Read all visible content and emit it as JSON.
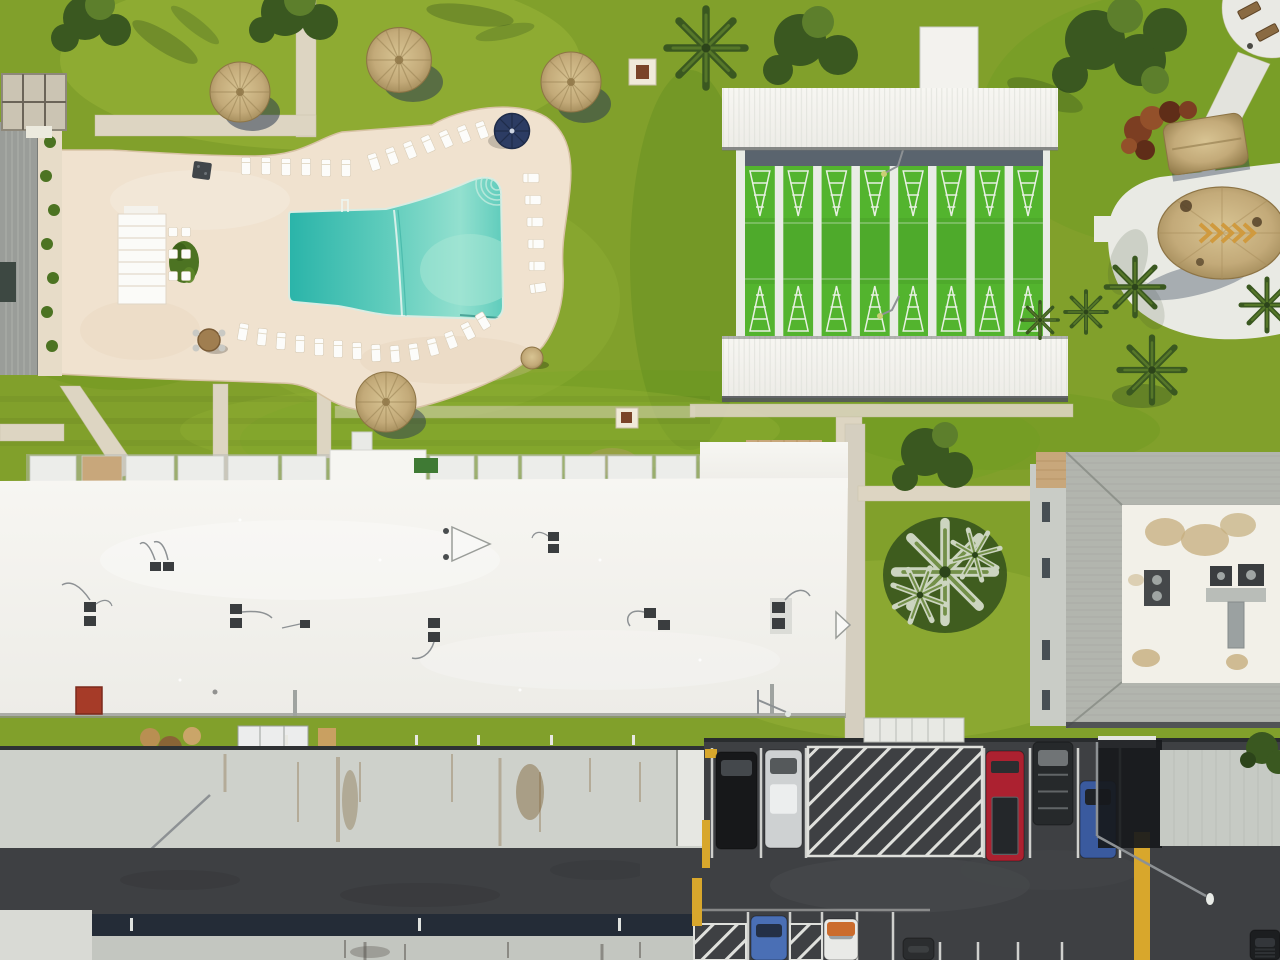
{
  "meta": {
    "title": "Aerial drone photo of a residential community recreation area",
    "view": "top-down orthographic aerial",
    "time_of_day": "midday, sun from upper-left",
    "width_px": 1280,
    "height_px": 960
  },
  "palette": {
    "grass_base": "#81a02b",
    "grass_light": "#9db73c",
    "grass_dark": "#628e1f",
    "grass_shadow": "#3a5a1c",
    "concrete": "#ddd5c2",
    "concrete_dark": "#c8bfa8",
    "deck": "#f0e2cf",
    "deck_edge": "#d8c3a6",
    "pool_deep": "#2ab4a9",
    "pool_mid": "#5fccbc",
    "pool_light": "#93e0cf",
    "lounger": "#fcfcfa",
    "umbrella": "#2c3c63",
    "roof_white": "#f3f2ee",
    "ridge": "#dcded7",
    "court_green": "#53b42e",
    "court_line": "#f0f4ec",
    "court_base": "#e9ece6",
    "walkway": "#5a646e",
    "thatch": "#c3aa79",
    "thatch_dark": "#97804f",
    "thatch_light": "#d8c493",
    "shadow_navy": "#2e3c52",
    "gray_roof": "#ced1cb",
    "rust": "#85653c",
    "asphalt": "#3e4043",
    "navy_band": "#242c37",
    "bottom_strip": "#c3c6c0",
    "line": "#dfe0dc",
    "yellow": "#d8a72c",
    "chimney": "#a63b28",
    "ac_unit": "#3a3d3f",
    "pipe": "#8d9194",
    "shingle": "#b2b5ae",
    "wall": "#c9ccc6",
    "condo_white": "#f2f0e8",
    "stain": "#c5ae7d",
    "duct": "#9ba1a1",
    "palm": "#3a5820",
    "palm_light": "#5d7f2c",
    "palm_silver": "#ccd5c0",
    "paver": "#c8a77b"
  },
  "features": {
    "pool": {
      "label": "free-form swimming pool with curved steps, lane rope and ladder",
      "deck": "cream concrete pool deck",
      "umbrella": "navy blue patio umbrella",
      "cabana": "white cabana with dining tables",
      "loungers": [
        [
          246,
          166,
          0,
          "v"
        ],
        [
          266,
          166,
          0,
          "v"
        ],
        [
          286,
          167,
          0,
          "v"
        ],
        [
          306,
          167,
          0,
          "v"
        ],
        [
          326,
          168,
          0,
          "v"
        ],
        [
          346,
          168,
          0,
          "v"
        ],
        [
          374,
          162,
          -18,
          "v"
        ],
        [
          392,
          156,
          -20,
          "v"
        ],
        [
          410,
          150,
          -22,
          "v"
        ],
        [
          428,
          144,
          -24,
          "v"
        ],
        [
          446,
          139,
          -24,
          "v"
        ],
        [
          464,
          134,
          -22,
          "v"
        ],
        [
          482,
          130,
          -20,
          "v"
        ],
        [
          531,
          178,
          0,
          "h"
        ],
        [
          533,
          200,
          0,
          "h"
        ],
        [
          535,
          222,
          0,
          "h"
        ],
        [
          536,
          244,
          0,
          "h"
        ],
        [
          537,
          266,
          0,
          "h"
        ],
        [
          538,
          288,
          -8,
          "h"
        ],
        [
          243,
          332,
          10,
          "v"
        ],
        [
          262,
          337,
          6,
          "v"
        ],
        [
          281,
          341,
          4,
          "v"
        ],
        [
          300,
          344,
          2,
          "v"
        ],
        [
          319,
          347,
          0,
          "v"
        ],
        [
          338,
          349,
          0,
          "v"
        ],
        [
          357,
          351,
          -2,
          "v"
        ],
        [
          376,
          353,
          -3,
          "v"
        ],
        [
          395,
          354,
          -5,
          "v"
        ],
        [
          414,
          352,
          -9,
          "v"
        ],
        [
          433,
          347,
          -15,
          "v"
        ],
        [
          451,
          340,
          -21,
          "v"
        ],
        [
          468,
          331,
          -27,
          "v"
        ],
        [
          483,
          321,
          -31,
          "v"
        ],
        [
          173,
          232,
          0,
          "s"
        ],
        [
          186,
          232,
          0,
          "s"
        ],
        [
          173,
          254,
          0,
          "s"
        ],
        [
          186,
          254,
          0,
          "s"
        ],
        [
          173,
          276,
          0,
          "s"
        ],
        [
          186,
          276,
          0,
          "s"
        ]
      ]
    },
    "shuffleboard": {
      "label": "covered shuffleboard courts with white metal canopies",
      "lane_count": 8
    },
    "tiki_huts": {
      "label": "thatched palapa umbrellas and huts",
      "umbrella_count": 4,
      "pavilion_count": 2
    },
    "buildings": [
      {
        "name": "clubhouse-left",
        "roof": "gray metal with courtyard planting"
      },
      {
        "name": "main-residence",
        "roof": "white flat membrane with HVAC units and red chimney"
      },
      {
        "name": "second-residence",
        "roof": "weathered light-gray with rust streaks"
      },
      {
        "name": "condo-right",
        "roof": "gray shingle mansard border around white flat roof"
      }
    ],
    "parking": {
      "label": "asphalt parking lot with white striping, hatched no-parking zones and yellow curbs",
      "vehicles": [
        {
          "kind": "car",
          "label": "black-car",
          "body": "#17181a",
          "window": "#44484c",
          "x": 716,
          "y": 752,
          "w": 41,
          "h": 97
        },
        {
          "kind": "car",
          "label": "silver-car",
          "body": "#ced1d2",
          "window": "#55595b",
          "accent": "#eceeee",
          "accent_pos": "mid",
          "x": 765,
          "y": 750,
          "w": 37,
          "h": 98
        },
        {
          "kind": "pickup",
          "label": "red-pickup",
          "body": "#ac2130",
          "window": "#2b2e30",
          "x": 986,
          "y": 751,
          "w": 38,
          "h": 110
        },
        {
          "kind": "suv",
          "label": "dark-suv-roof-rack",
          "body": "#26292b",
          "window": "#707476",
          "x": 1033,
          "y": 742,
          "w": 40,
          "h": 83
        },
        {
          "kind": "car",
          "label": "blue-car",
          "body": "#3a5a9e",
          "window": "#1f2328",
          "x": 1080,
          "y": 781,
          "w": 36,
          "h": 77
        },
        {
          "kind": "car",
          "label": "blue-car-2",
          "body": "#4a6fb5",
          "window": "#243046",
          "x": 751,
          "y": 916,
          "w": 36,
          "h": 44
        },
        {
          "kind": "car",
          "label": "white-car-orange-hood",
          "body": "#e9eae7",
          "window": "#9aa0a4",
          "accent": "#cb6c2d",
          "accent_pos": "top",
          "x": 824,
          "y": 919,
          "w": 34,
          "h": 41
        },
        {
          "kind": "car",
          "label": "dark-car",
          "body": "#2b2d2f",
          "window": "#3c3f41",
          "x": 903,
          "y": 938,
          "w": 31,
          "h": 22
        },
        {
          "kind": "suv",
          "label": "dark-suv-corner",
          "body": "#1c1e20",
          "window": "#33363a",
          "x": 1250,
          "y": 930,
          "w": 30,
          "h": 30
        }
      ]
    },
    "landscape": {
      "label": "lawns, palms, shade trees, concrete walkways, circular bench patio"
    }
  }
}
